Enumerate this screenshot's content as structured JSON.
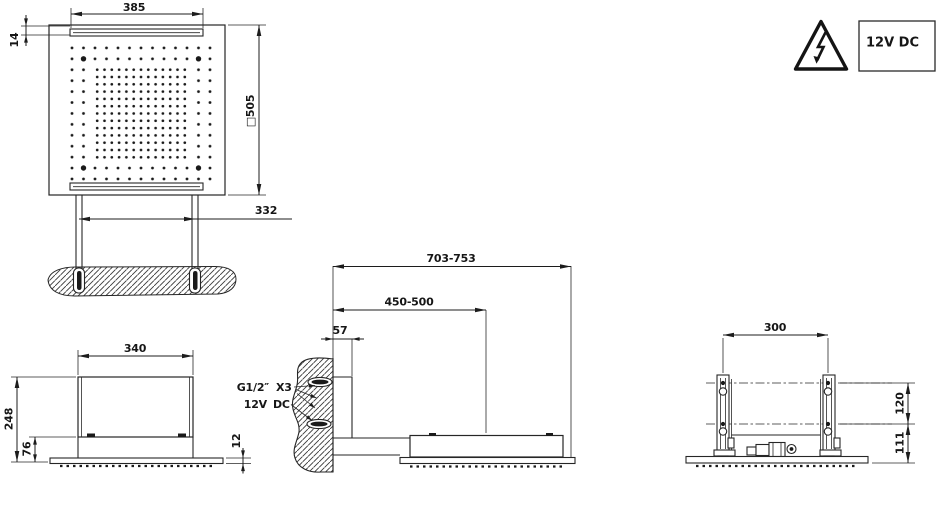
{
  "colors": {
    "ink": "#1f1f1f",
    "background": "#ffffff"
  },
  "plan_view": {
    "top_width": "385",
    "slot_height": "14",
    "square_size": "□505",
    "anchor_spacing": "332"
  },
  "warning": {
    "icon": "high-voltage-warning-triangle",
    "rating": "12V DC"
  },
  "side_view": {
    "body_width": "340",
    "total_height": "248",
    "base_height": "76",
    "plate_thickness": "12"
  },
  "installation_view": {
    "max_reach": "703-753",
    "center_distance": "450-500",
    "wall_offset": "57",
    "water_inlet_thread": "G1/2″",
    "water_inlet_count": "X3",
    "power_voltage": "12V",
    "power_current": "DC"
  },
  "front_view": {
    "bracket_spacing": "300",
    "upper_height": "120",
    "lower_height": "111"
  }
}
